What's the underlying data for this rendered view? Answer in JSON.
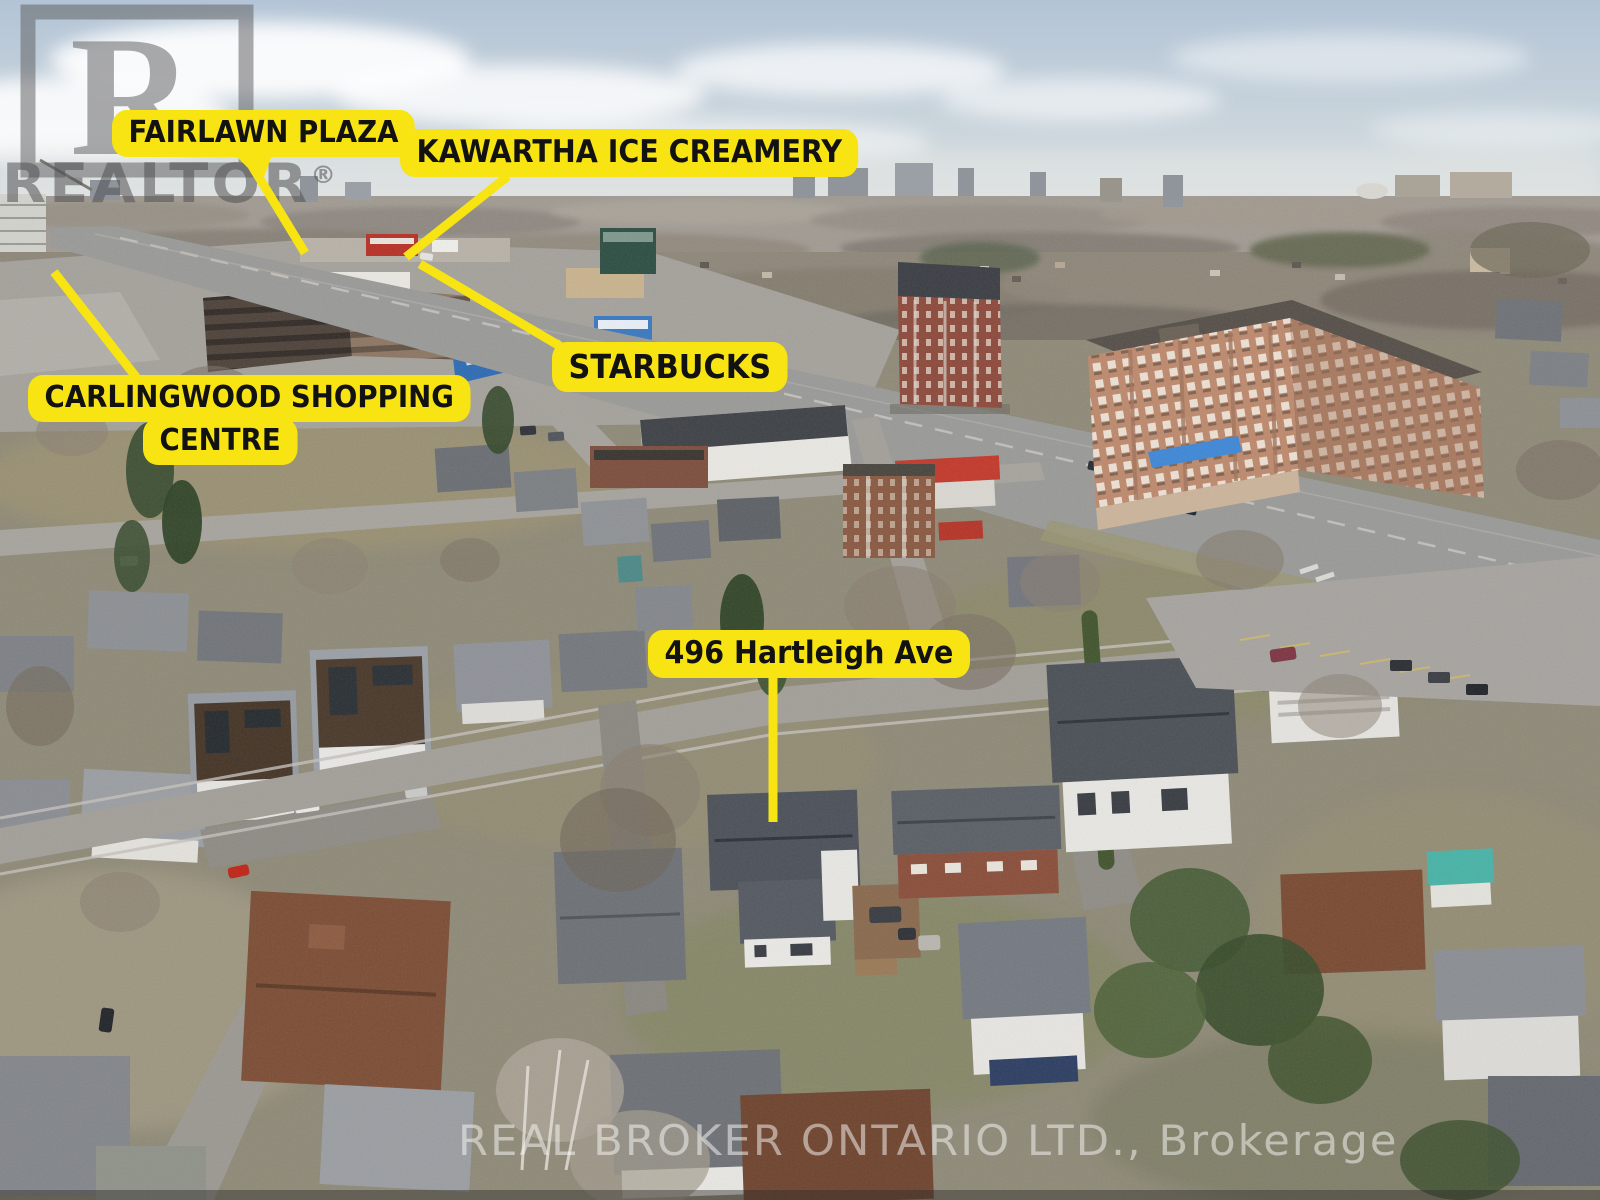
{
  "photo": {
    "callouts": {
      "fairlawn": "FAIRLAWN PLAZA",
      "kawartha": "KAWARTHA ICE CREAMERY",
      "carlingwood_line1": "CARLINGWOOD SHOPPING",
      "carlingwood_line2": "CENTRE",
      "starbucks": "STARBUCKS",
      "address": "496 Hartleigh Ave"
    },
    "watermarks": {
      "logo_letter": "R",
      "logo_word": "REALTOR",
      "logo_reg_mark": "®",
      "brokerage": "REAL BROKER ONTARIO LTD., Brokerage"
    },
    "colors": {
      "callout_bg": "#F7E412",
      "callout_text": "#121212"
    }
  }
}
